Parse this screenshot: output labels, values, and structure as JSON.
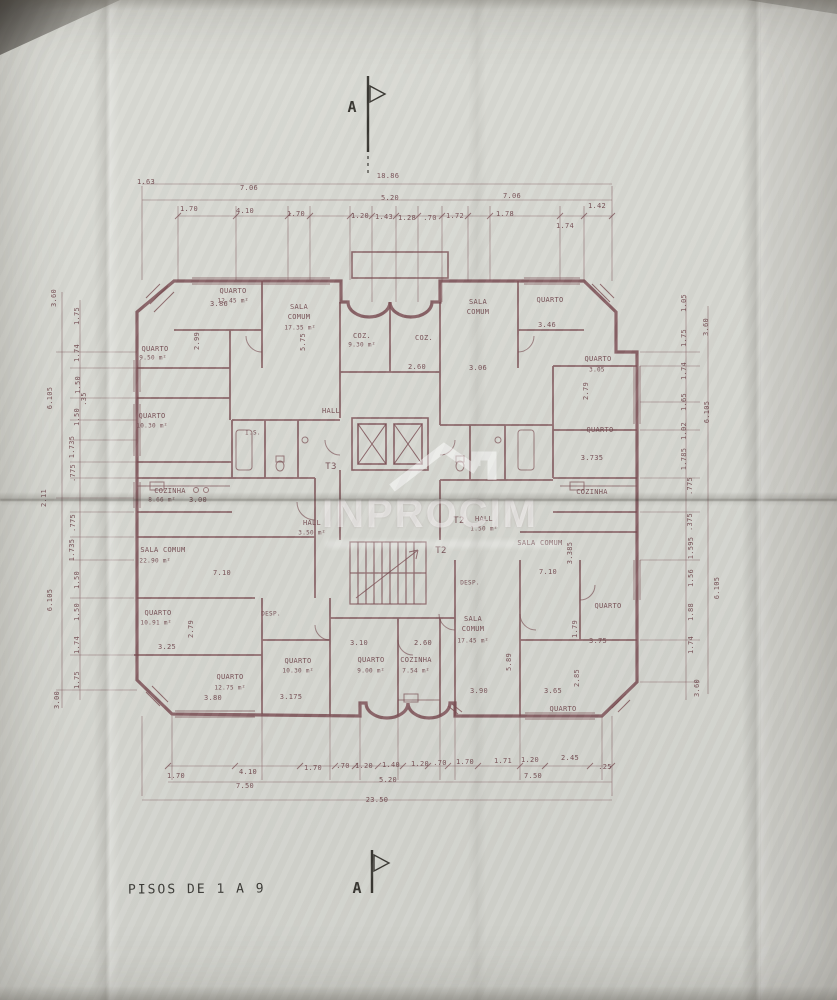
{
  "title": {
    "text": "PISOS DE 1 A 9"
  },
  "section_markers": {
    "top": "A",
    "bottom": "A"
  },
  "watermark": {
    "text": "INPROCIM"
  },
  "colors": {
    "paper": "#d7d8d2",
    "ink": "#7a4e53",
    "marker_ink": "#3a3833",
    "title_ink": "#3c3b37"
  },
  "labels": {
    "rooms": [
      {
        "t": "QUARTO",
        "x": 233,
        "y": 291
      },
      {
        "t": "12.45 m²",
        "x": 233,
        "y": 301,
        "s": 6
      },
      {
        "t": "SALA",
        "x": 299,
        "y": 307
      },
      {
        "t": "COMUM",
        "x": 299,
        "y": 317
      },
      {
        "t": "17.35 m²",
        "x": 300,
        "y": 328,
        "s": 6
      },
      {
        "t": "COZ.",
        "x": 362,
        "y": 336
      },
      {
        "t": "9.30 m²",
        "x": 362,
        "y": 345,
        "s": 6
      },
      {
        "t": "COZ.",
        "x": 424,
        "y": 338
      },
      {
        "t": "SALA",
        "x": 478,
        "y": 302
      },
      {
        "t": "COMUM",
        "x": 478,
        "y": 312
      },
      {
        "t": "QUARTO",
        "x": 550,
        "y": 300
      },
      {
        "t": "QUARTO",
        "x": 598,
        "y": 359
      },
      {
        "t": "3.05",
        "x": 597,
        "y": 370,
        "s": 6
      },
      {
        "t": "QUARTO",
        "x": 600,
        "y": 430
      },
      {
        "t": "QUARTO",
        "x": 155,
        "y": 349
      },
      {
        "t": "9.50 m²",
        "x": 153,
        "y": 358,
        "s": 6
      },
      {
        "t": "QUARTO",
        "x": 152,
        "y": 416
      },
      {
        "t": "10.30 m²",
        "x": 152,
        "y": 426,
        "s": 6
      },
      {
        "t": "HALL",
        "x": 331,
        "y": 411
      },
      {
        "t": "I.S.",
        "x": 253,
        "y": 433,
        "s": 6
      },
      {
        "t": "T3",
        "x": 331,
        "y": 467,
        "s": 9
      },
      {
        "t": "COZINHA",
        "x": 170,
        "y": 491
      },
      {
        "t": "8.66 m²",
        "x": 162,
        "y": 500,
        "s": 6
      },
      {
        "t": "COZINHA",
        "x": 592,
        "y": 492
      },
      {
        "t": "HALL",
        "x": 312,
        "y": 523
      },
      {
        "t": "3.50 m²",
        "x": 312,
        "y": 533,
        "s": 6
      },
      {
        "t": "HALL",
        "x": 484,
        "y": 519
      },
      {
        "t": "1.50 m²",
        "x": 484,
        "y": 529,
        "s": 6
      },
      {
        "t": "T2",
        "x": 459,
        "y": 521,
        "s": 9
      },
      {
        "t": "T2",
        "x": 441,
        "y": 551,
        "s": 9
      },
      {
        "t": "SALA COMUM",
        "x": 540,
        "y": 543
      },
      {
        "t": "SALA COMUM",
        "x": 163,
        "y": 550
      },
      {
        "t": "22.90 m²",
        "x": 155,
        "y": 561,
        "s": 6
      },
      {
        "t": "QUARTO",
        "x": 158,
        "y": 613
      },
      {
        "t": "10.91 m²",
        "x": 156,
        "y": 623,
        "s": 6
      },
      {
        "t": "DESP.",
        "x": 271,
        "y": 614,
        "s": 6
      },
      {
        "t": "DESP.",
        "x": 470,
        "y": 583,
        "s": 6
      },
      {
        "t": "QUARTO",
        "x": 230,
        "y": 677
      },
      {
        "t": "12.75 m²",
        "x": 230,
        "y": 688,
        "s": 6
      },
      {
        "t": "QUARTO",
        "x": 298,
        "y": 661
      },
      {
        "t": "10.30 m²",
        "x": 298,
        "y": 671,
        "s": 6
      },
      {
        "t": "QUARTO",
        "x": 371,
        "y": 660
      },
      {
        "t": "9.00 m²",
        "x": 371,
        "y": 671,
        "s": 6
      },
      {
        "t": "COZINHA",
        "x": 416,
        "y": 660
      },
      {
        "t": "7.54 m²",
        "x": 416,
        "y": 671,
        "s": 6
      },
      {
        "t": "SALA",
        "x": 473,
        "y": 619
      },
      {
        "t": "COMUM",
        "x": 473,
        "y": 629
      },
      {
        "t": "17.45 m²",
        "x": 473,
        "y": 641,
        "s": 6
      },
      {
        "t": "QUARTO",
        "x": 608,
        "y": 606
      },
      {
        "t": "QUARTO",
        "x": 563,
        "y": 709
      }
    ],
    "dims_top": [
      {
        "t": "1.63",
        "x": 146,
        "y": 182
      },
      {
        "t": "7.06",
        "x": 249,
        "y": 188
      },
      {
        "t": "18.86",
        "x": 388,
        "y": 176
      },
      {
        "t": "5.20",
        "x": 390,
        "y": 198
      },
      {
        "t": "7.06",
        "x": 512,
        "y": 196
      },
      {
        "t": "1.42",
        "x": 597,
        "y": 206
      },
      {
        "t": "1.70",
        "x": 189,
        "y": 209
      },
      {
        "t": "4.10",
        "x": 245,
        "y": 211
      },
      {
        "t": "1.70",
        "x": 296,
        "y": 214
      },
      {
        "t": "1.20",
        "x": 360,
        "y": 216
      },
      {
        "t": "1.43",
        "x": 384,
        "y": 217
      },
      {
        "t": "1.28",
        "x": 407,
        "y": 218
      },
      {
        "t": ".70",
        "x": 430,
        "y": 218
      },
      {
        "t": "1.72",
        "x": 455,
        "y": 216
      },
      {
        "t": "1.78",
        "x": 505,
        "y": 214
      },
      {
        "t": "1.74",
        "x": 565,
        "y": 226
      }
    ],
    "dims_bottom": [
      {
        "t": "1.70",
        "x": 176,
        "y": 776
      },
      {
        "t": "4.10",
        "x": 248,
        "y": 772
      },
      {
        "t": "1.70",
        "x": 313,
        "y": 768
      },
      {
        "t": ".70",
        "x": 343,
        "y": 766
      },
      {
        "t": "1.20",
        "x": 364,
        "y": 766
      },
      {
        "t": "1.40",
        "x": 391,
        "y": 765
      },
      {
        "t": "1.20",
        "x": 420,
        "y": 764
      },
      {
        "t": ".70",
        "x": 440,
        "y": 763
      },
      {
        "t": "1.70",
        "x": 465,
        "y": 762
      },
      {
        "t": "1.71",
        "x": 503,
        "y": 761
      },
      {
        "t": "1.20",
        "x": 530,
        "y": 760
      },
      {
        "t": "2.45",
        "x": 570,
        "y": 758
      },
      {
        "t": ".25",
        "x": 605,
        "y": 767
      },
      {
        "t": "7.50",
        "x": 245,
        "y": 786
      },
      {
        "t": "5.20",
        "x": 388,
        "y": 780
      },
      {
        "t": "7.50",
        "x": 533,
        "y": 776
      },
      {
        "t": "23.50",
        "x": 377,
        "y": 800
      }
    ],
    "dims_left": [
      {
        "t": "3.60",
        "x": 54,
        "y": 298,
        "r": -90
      },
      {
        "t": "1.75",
        "x": 77,
        "y": 316,
        "r": -90
      },
      {
        "t": "1.74",
        "x": 77,
        "y": 353,
        "r": -90
      },
      {
        "t": "1.50",
        "x": 78,
        "y": 385,
        "r": -90
      },
      {
        "t": ".35",
        "x": 84,
        "y": 399,
        "r": -90
      },
      {
        "t": "1.50",
        "x": 77,
        "y": 417,
        "r": -90
      },
      {
        "t": "1.735",
        "x": 72,
        "y": 447,
        "r": -90
      },
      {
        "t": ".775",
        "x": 73,
        "y": 473,
        "r": -90
      },
      {
        "t": "6.105",
        "x": 50,
        "y": 398,
        "r": -90
      },
      {
        "t": "2.11",
        "x": 44,
        "y": 498,
        "r": -90
      },
      {
        "t": ".775",
        "x": 73,
        "y": 523,
        "r": -90
      },
      {
        "t": "1.735",
        "x": 72,
        "y": 550,
        "r": -90
      },
      {
        "t": "1.50",
        "x": 77,
        "y": 580,
        "r": -90
      },
      {
        "t": "1.50",
        "x": 77,
        "y": 612,
        "r": -90
      },
      {
        "t": "1.74",
        "x": 77,
        "y": 645,
        "r": -90
      },
      {
        "t": "1.75",
        "x": 77,
        "y": 680,
        "r": -90
      },
      {
        "t": "3.00",
        "x": 57,
        "y": 700,
        "r": -90
      },
      {
        "t": "6.105",
        "x": 50,
        "y": 600,
        "r": -90
      }
    ],
    "dims_right": [
      {
        "t": "1.05",
        "x": 684,
        "y": 303,
        "r": -90
      },
      {
        "t": "3.60",
        "x": 706,
        "y": 327,
        "r": -90
      },
      {
        "t": "1.75",
        "x": 684,
        "y": 338,
        "r": -90
      },
      {
        "t": "1.74",
        "x": 684,
        "y": 371,
        "r": -90
      },
      {
        "t": "1.65",
        "x": 684,
        "y": 402,
        "r": -90
      },
      {
        "t": "1.02",
        "x": 684,
        "y": 431,
        "r": -90
      },
      {
        "t": "1.785",
        "x": 684,
        "y": 459,
        "r": -90
      },
      {
        "t": "6.105",
        "x": 707,
        "y": 412,
        "r": -90
      },
      {
        "t": ".775",
        "x": 690,
        "y": 486,
        "r": -90
      },
      {
        "t": ".375",
        "x": 690,
        "y": 522,
        "r": -90
      },
      {
        "t": "1.595",
        "x": 691,
        "y": 548,
        "r": -90
      },
      {
        "t": "1.56",
        "x": 691,
        "y": 578,
        "r": -90
      },
      {
        "t": "1.88",
        "x": 691,
        "y": 612,
        "r": -90
      },
      {
        "t": "1.74",
        "x": 691,
        "y": 645,
        "r": -90
      },
      {
        "t": "3.60",
        "x": 697,
        "y": 688,
        "r": -90
      },
      {
        "t": "6.105",
        "x": 717,
        "y": 588,
        "r": -90
      }
    ],
    "dims_inner": [
      {
        "t": "3.86",
        "x": 219,
        "y": 304
      },
      {
        "t": "5.75",
        "x": 303,
        "y": 342,
        "r": -90
      },
      {
        "t": "2.99",
        "x": 197,
        "y": 341,
        "r": -90
      },
      {
        "t": "2.60",
        "x": 417,
        "y": 367
      },
      {
        "t": "3.06",
        "x": 478,
        "y": 368
      },
      {
        "t": "3.46",
        "x": 547,
        "y": 325
      },
      {
        "t": "2.79",
        "x": 586,
        "y": 391,
        "r": -90
      },
      {
        "t": "3.735",
        "x": 592,
        "y": 458
      },
      {
        "t": "3.00",
        "x": 198,
        "y": 500
      },
      {
        "t": "7.10",
        "x": 222,
        "y": 573
      },
      {
        "t": "3.25",
        "x": 167,
        "y": 647
      },
      {
        "t": "2.79",
        "x": 191,
        "y": 629,
        "r": -90
      },
      {
        "t": "3.80",
        "x": 213,
        "y": 698
      },
      {
        "t": "3.175",
        "x": 291,
        "y": 697
      },
      {
        "t": "3.10",
        "x": 359,
        "y": 643
      },
      {
        "t": "2.60",
        "x": 423,
        "y": 643
      },
      {
        "t": "3.90",
        "x": 479,
        "y": 691
      },
      {
        "t": "3.65",
        "x": 553,
        "y": 691
      },
      {
        "t": "5.89",
        "x": 509,
        "y": 662,
        "r": -90
      },
      {
        "t": "1.79",
        "x": 575,
        "y": 629,
        "r": -90
      },
      {
        "t": "2.85",
        "x": 577,
        "y": 678,
        "r": -90
      },
      {
        "t": "3.75",
        "x": 598,
        "y": 641
      },
      {
        "t": "7.10",
        "x": 548,
        "y": 572
      },
      {
        "t": "3.385",
        "x": 570,
        "y": 553,
        "r": -90
      }
    ]
  }
}
